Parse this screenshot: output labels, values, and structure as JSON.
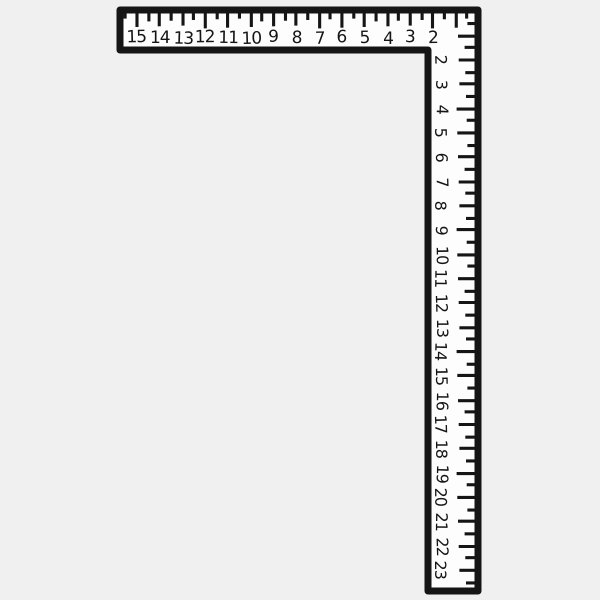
{
  "illustration": {
    "object": "framing-square",
    "colors": {
      "background": "#f0f0f0",
      "face": "#fdfdfd",
      "ink": "#151515"
    },
    "blade": {
      "orientation": "horizontal",
      "numbers": [
        "15",
        "14",
        "13",
        "12",
        "11",
        "10",
        "9",
        "8",
        "7",
        "6",
        "5",
        "4",
        "3",
        "2"
      ]
    },
    "tongue": {
      "orientation": "vertical",
      "numbers": [
        "2",
        "3",
        "4",
        "5",
        "6",
        "7",
        "8",
        "9",
        "10",
        "11",
        "12",
        "13",
        "14",
        "15",
        "16",
        "17",
        "18",
        "19",
        "20",
        "21",
        "22",
        "23"
      ]
    }
  }
}
